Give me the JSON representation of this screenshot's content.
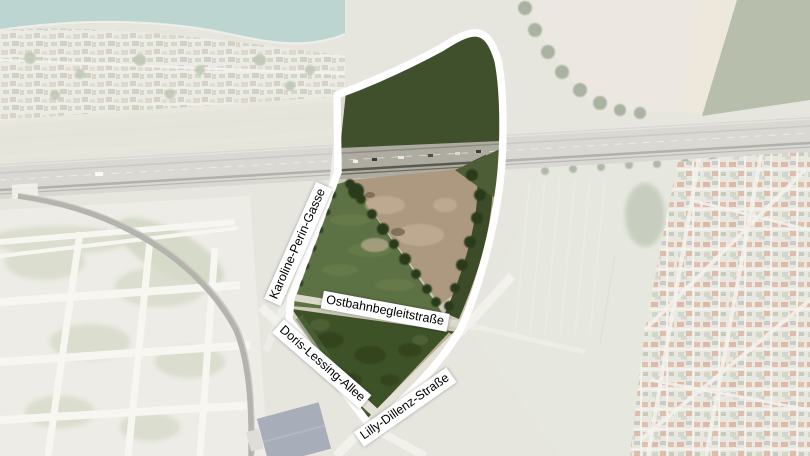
{
  "map": {
    "street_labels": [
      {
        "id": "karoline-perin-gasse",
        "text": "Karoline-Perin-Gasse"
      },
      {
        "id": "ostbahnbegleitstrasse",
        "text": "Ostbahnbegleitstraße"
      },
      {
        "id": "doris-lessing-allee",
        "text": "Doris-Lessing-Allee"
      },
      {
        "id": "lilly-dillenz-strasse",
        "text": "Lilly-Dillenz-Straße"
      }
    ],
    "colors": {
      "site_outline": "#ffffff",
      "forest_green": "#40502c",
      "meadow_green": "#5d7244",
      "south_field_green": "#3e5228",
      "bare_field_brown": "#ad9980",
      "lake_teal": "#74a79b",
      "washed_overlay_white": "#ffffff"
    }
  }
}
